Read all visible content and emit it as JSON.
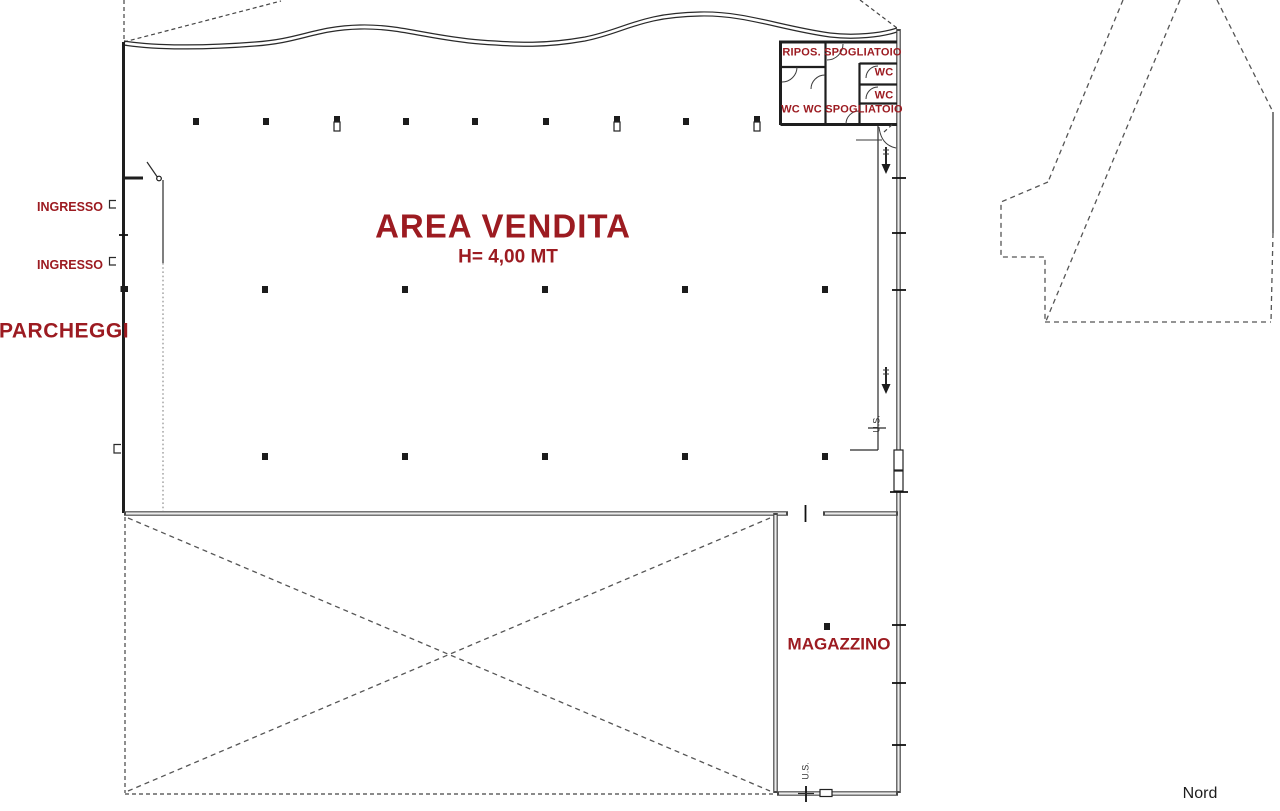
{
  "plan": {
    "title": "AREA VENDITA",
    "height_note": "H= 4,00 MT",
    "colors": {
      "label_red": "#9c1b21",
      "line_black": "#1e1e1e"
    },
    "labels": {
      "area_vendita": "AREA VENDITA",
      "area_height": "H= 4,00 MT",
      "parcheggi": "PARCHEGGI",
      "ingresso_1": "INGRESSO",
      "ingresso_2": "INGRESSO",
      "magazzino": "MAGAZZINO",
      "nord": "Nord",
      "ripos_spogliatoio": "RIPOS. SPOGLIATOIO",
      "wc_1": "WC",
      "wc_2": "WC",
      "wc_wc_spogliatoio": "WC WC SPOGLIATOIO",
      "us_right": "U.S.",
      "us_bottom": "U.S."
    }
  }
}
